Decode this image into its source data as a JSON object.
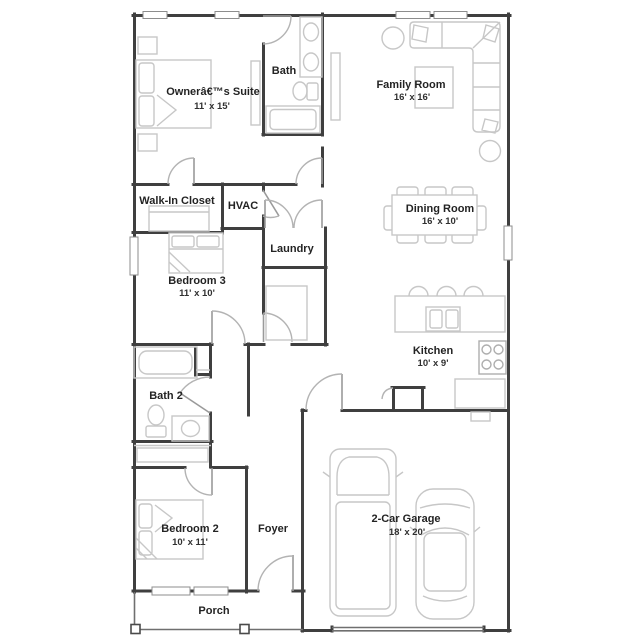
{
  "colors": {
    "wall": "#3f3f3f",
    "furniture": "#c7c7c7",
    "door_arc": "#b3b3b3",
    "text": "#232323",
    "background": "#ffffff"
  },
  "rooms": {
    "owners_suite": {
      "name": "Ownerâ€™s Suite",
      "dims": "11' x 15'"
    },
    "bath": {
      "name": "Bath"
    },
    "family_room": {
      "name": "Family Room",
      "dims": "16' x 16'"
    },
    "walk_in_closet": {
      "name": "Walk-In Closet"
    },
    "hvac": {
      "name": "HVAC"
    },
    "dining_room": {
      "name": "Dining Room",
      "dims": "16' x 10'"
    },
    "laundry": {
      "name": "Laundry"
    },
    "bedroom_3": {
      "name": "Bedroom 3",
      "dims": "11' x 10'"
    },
    "kitchen": {
      "name": "Kitchen",
      "dims": "10' x 9'"
    },
    "bath_2": {
      "name": "Bath 2"
    },
    "bedroom_2": {
      "name": "Bedroom 2",
      "dims": "10' x 11'"
    },
    "foyer": {
      "name": "Foyer"
    },
    "garage": {
      "name": "2-Car Garage",
      "dims": "18' x 20'"
    },
    "porch": {
      "name": "Porch"
    }
  }
}
